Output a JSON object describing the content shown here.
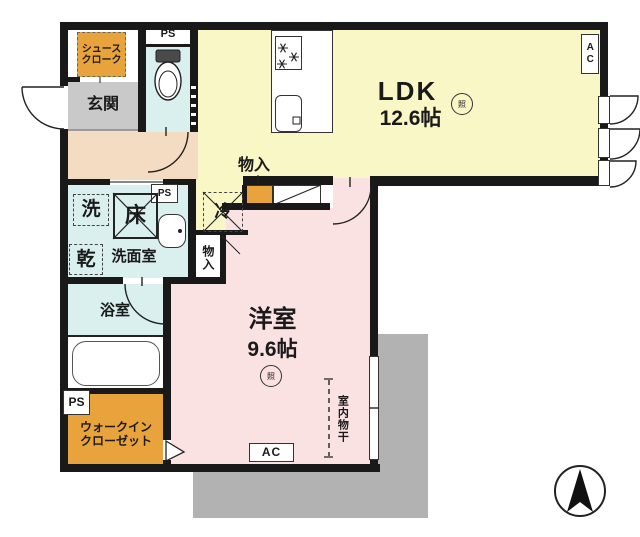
{
  "plan": {
    "ldk": {
      "name": "LDK",
      "area": "12.6帖"
    },
    "western_room": {
      "name": "洋室",
      "area": "9.6帖"
    },
    "entrance": {
      "name": "玄関"
    },
    "shoe_closet": {
      "name": "シュース\nクローク"
    },
    "washroom": {
      "name": "洗面室"
    },
    "bathroom": {
      "name": "浴室"
    },
    "walk_in_closet": {
      "name": "ウォークイン\nクローゼット"
    },
    "storage": {
      "name": "物入"
    },
    "indoor_drying": {
      "name": "室内物干"
    },
    "fridge": {
      "name": "冷"
    },
    "washer": {
      "name": "洗"
    },
    "floor_hatch": {
      "name": "床"
    },
    "dryer": {
      "name": "乾"
    },
    "pipe_space": {
      "name": "PS"
    },
    "air_con": {
      "name": "AC"
    },
    "light": {
      "name": "照"
    }
  },
  "colors": {
    "wall": "#191919",
    "ldk_fill": "#f9f7c5",
    "western_fill": "#fae2e2",
    "wet_area_fill": "#d9f0ef",
    "closet_fill": "#e8a33c",
    "entrance_fill": "#c9c9c9",
    "hall_fill": "#f3dcc2",
    "balcony_fill": "#b2b2b2"
  }
}
